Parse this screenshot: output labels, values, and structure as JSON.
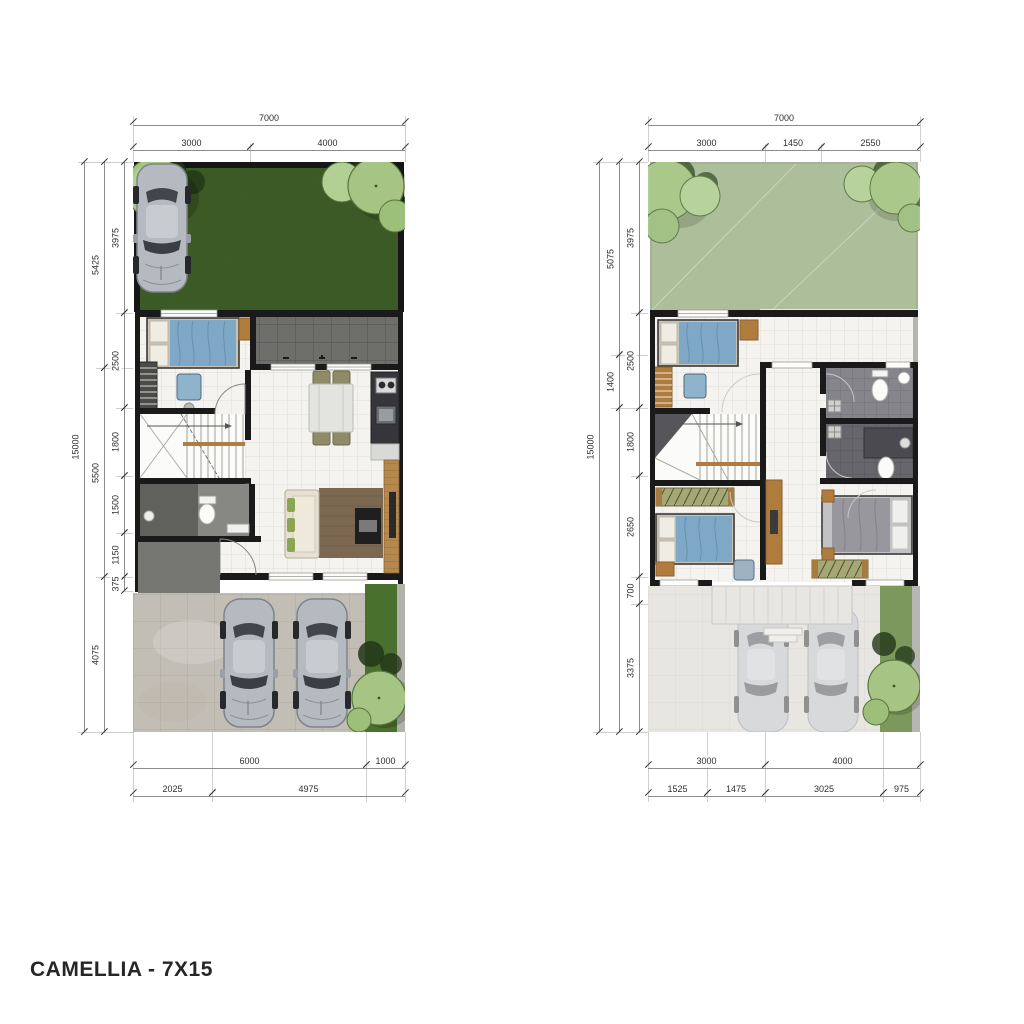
{
  "title": "CAMELLIA - 7X15",
  "plans": [
    {
      "id": "ground-floor",
      "top": {
        "total": "7000",
        "row2": [
          "3000",
          "4000"
        ]
      },
      "left": {
        "total": "15000",
        "chain_a": [
          "5425",
          "5500",
          "4075"
        ],
        "chain_b": [
          "3975",
          "2500",
          "1800",
          "1500",
          "1150",
          "375"
        ]
      },
      "bottom": {
        "row1": [
          "6000",
          "1000"
        ],
        "row2": [
          "2025",
          "4975"
        ]
      }
    },
    {
      "id": "upper-floor",
      "top": {
        "total": "7000",
        "row2": [
          "3000",
          "1450",
          "2550"
        ]
      },
      "left": {
        "total": "15000",
        "chain_a": [
          "5075",
          "1400"
        ],
        "chain_b": [
          "3975",
          "2500",
          "1800",
          "2650",
          "700",
          "3375"
        ]
      },
      "bottom": {
        "row1": [
          "3000",
          "4000"
        ],
        "row2": [
          "1525",
          "1475",
          "3025",
          "975"
        ]
      }
    }
  ],
  "colors": {
    "wall": "#1a1a1a",
    "grass": "#4c7530",
    "grass_faded": "#bccfa8",
    "patio_tile": "#7b7b77",
    "interior_tile": "#f4f3f0",
    "driveway": "#d2cdc4",
    "entry_paving": "#8e8e8a",
    "wood": "#b5884f",
    "bed_blue": "#7fa8c7",
    "bed_gray": "#97979d",
    "sofa_cream": "#e7e0d2",
    "cushion_green": "#8aa554",
    "car_silver": "#b5bac0",
    "tree_green": "#a6c584",
    "lawn_strip": "#5b8a39",
    "dim_line": "#8c8c8c",
    "title_text": "#262626"
  }
}
